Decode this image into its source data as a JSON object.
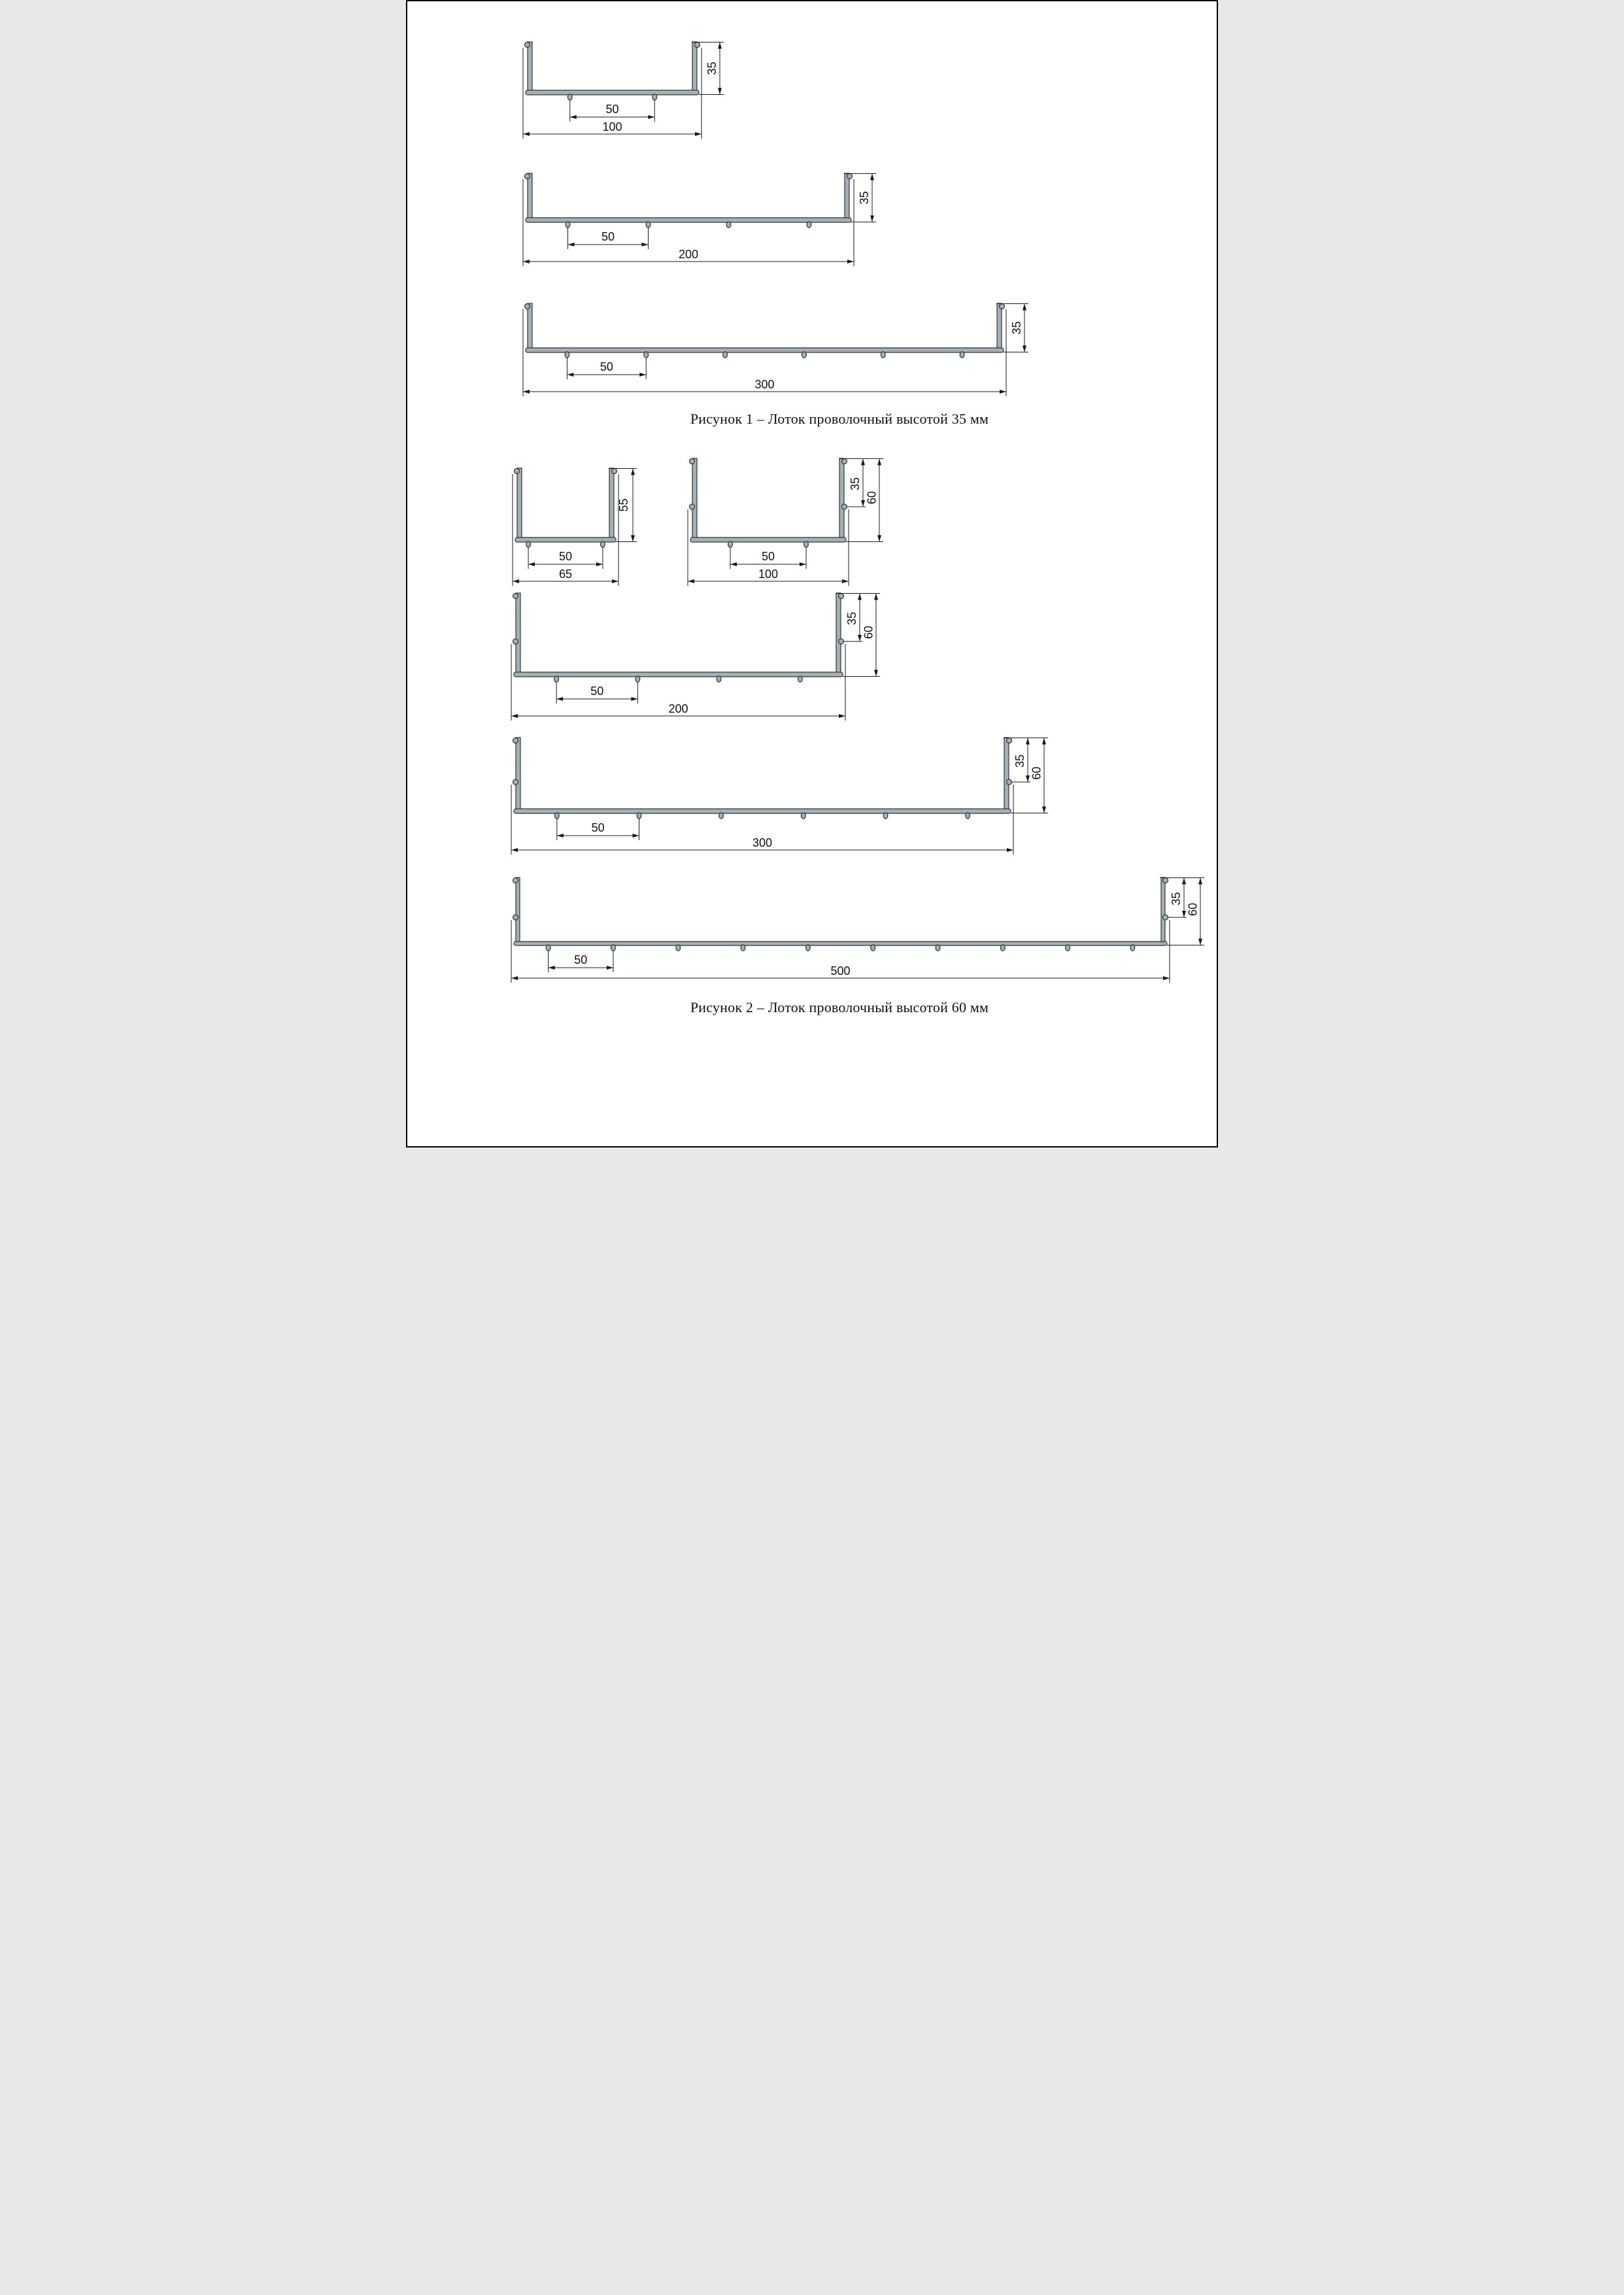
{
  "colors": {
    "background": "#ffffff",
    "page_border": "#000000",
    "steel_fill": "#a4b0b4",
    "steel_outline": "#2e3538",
    "dimension_line": "#1a1a1a",
    "text": "#111111"
  },
  "figures": [
    {
      "caption": "Рисунок 1 – Лоток проволочный высотой 35 мм",
      "trays": [
        {
          "name": "tray-100x35",
          "width_mm": 100,
          "height_mm": 35,
          "wire_spacing_mm": 50,
          "bottom_wire_count": 2,
          "labels": {
            "width": "100",
            "height": "35",
            "spacing": "50"
          }
        },
        {
          "name": "tray-200x35",
          "width_mm": 200,
          "height_mm": 35,
          "wire_spacing_mm": 50,
          "bottom_wire_count": 4,
          "labels": {
            "width": "200",
            "height": "35",
            "spacing": "50"
          }
        },
        {
          "name": "tray-300x35",
          "width_mm": 300,
          "height_mm": 35,
          "wire_spacing_mm": 50,
          "bottom_wire_count": 6,
          "labels": {
            "width": "300",
            "height": "35",
            "spacing": "50"
          }
        }
      ]
    },
    {
      "caption": "Рисунок 2 – Лоток проволочный высотой 60 мм",
      "trays": [
        {
          "name": "tray-65x55",
          "width_mm": 65,
          "height_mm": 55,
          "wire_spacing_mm": 50,
          "bottom_wire_count": 2,
          "labels": {
            "width": "65",
            "height": "55",
            "spacing": "50"
          }
        },
        {
          "name": "tray-100x60",
          "width_mm": 100,
          "height_mm": 60,
          "mid_wire_mm": 35,
          "wire_spacing_mm": 50,
          "bottom_wire_count": 2,
          "labels": {
            "width": "100",
            "height": "60",
            "mid": "35",
            "spacing": "50"
          }
        },
        {
          "name": "tray-200x60",
          "width_mm": 200,
          "height_mm": 60,
          "mid_wire_mm": 35,
          "wire_spacing_mm": 50,
          "bottom_wire_count": 4,
          "labels": {
            "width": "200",
            "height": "60",
            "mid": "35",
            "spacing": "50"
          }
        },
        {
          "name": "tray-300x60",
          "width_mm": 300,
          "height_mm": 60,
          "mid_wire_mm": 35,
          "wire_spacing_mm": 50,
          "bottom_wire_count": 6,
          "labels": {
            "width": "300",
            "height": "60",
            "mid": "35",
            "spacing": "50"
          }
        },
        {
          "name": "tray-500x60",
          "width_mm": 500,
          "height_mm": 60,
          "mid_wire_mm": 35,
          "wire_spacing_mm": 50,
          "bottom_wire_count": 10,
          "labels": {
            "width": "500",
            "height": "60",
            "mid": "35",
            "spacing": "50"
          }
        }
      ]
    }
  ]
}
